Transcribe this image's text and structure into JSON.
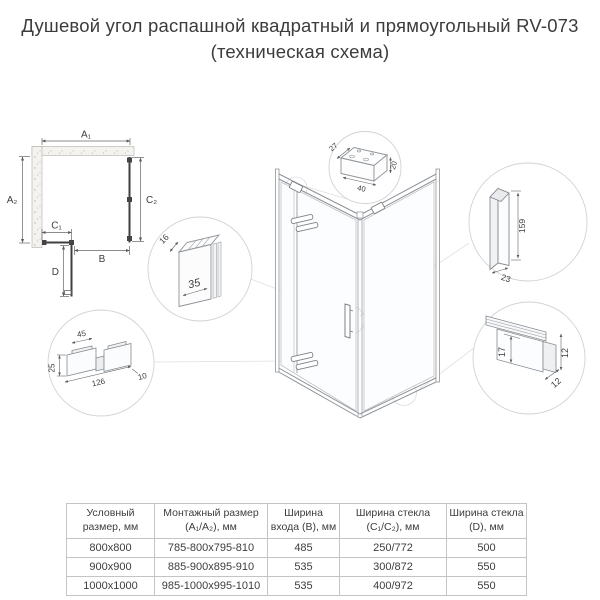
{
  "title": {
    "line1": "Душевой угол распашной квадратный и прямоугольный RV-073",
    "line2": "(техническая схема)"
  },
  "plan": {
    "a1": "A₁",
    "a2": "A₂",
    "c1": "C₁",
    "c2": "C₂",
    "b": "B",
    "d": "D"
  },
  "details": {
    "bracket": {
      "depth": "27",
      "height": "20",
      "width": "40"
    },
    "wall_profile": {
      "depth": "16",
      "width": "35"
    },
    "handle": {
      "height": "159",
      "width": "23"
    },
    "hinge": {
      "tab": "45",
      "height": "25",
      "length": "126",
      "thickness": "10"
    },
    "bottom_profile": {
      "glass": "17",
      "height": "12",
      "depth": "12"
    }
  },
  "table": {
    "headers": [
      "Условный размер, мм",
      "Монтажный размер (A₁/A₂), мм",
      "Ширина входа (B), мм",
      "Ширина стекла (C₁/C₂), мм",
      "Ширина стекла (D), мм"
    ],
    "rows": [
      [
        "800x800",
        "785-800x795-810",
        "485",
        "250/772",
        "500"
      ],
      [
        "900x900",
        "885-900x895-910",
        "535",
        "300/872",
        "550"
      ],
      [
        "1000x1000",
        "985-1000x995-1010",
        "535",
        "400/972",
        "550"
      ]
    ]
  }
}
